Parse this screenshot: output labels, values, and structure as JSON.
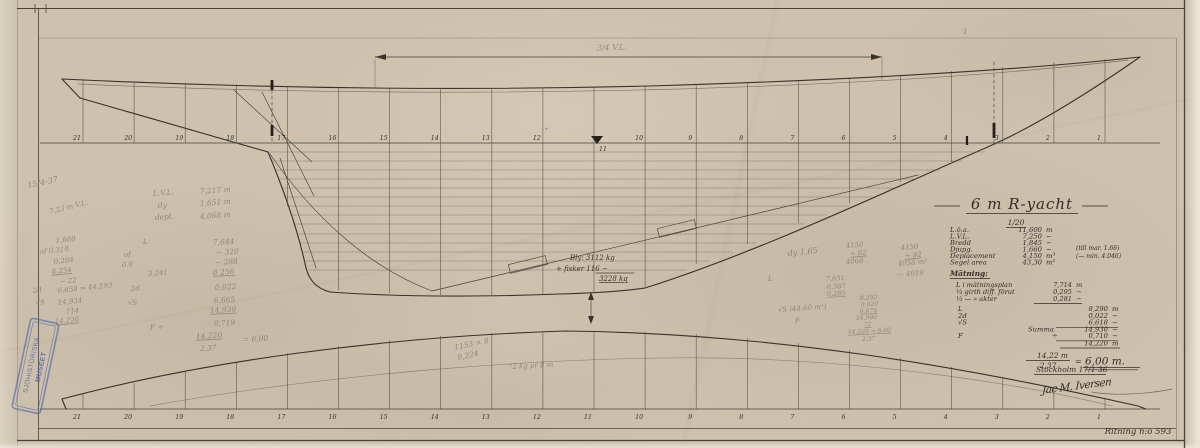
{
  "dimension_label": "3/4 V.L.",
  "top_mark": "1",
  "stations": [
    "21",
    "20",
    "19",
    "18",
    "17",
    "16",
    "15",
    "14",
    "13",
    "12",
    "11",
    "10",
    "9",
    "8",
    "7",
    "6",
    "5",
    "4",
    "3",
    "2",
    "1"
  ],
  "ink_notes": [
    {
      "t": "Bly: 3112 kg",
      "x": 570,
      "y": 260,
      "s": 7
    },
    {
      "t": "+ fisker 116 −",
      "x": 556,
      "y": 271,
      "s": 7
    },
    {
      "t": "3228 kg",
      "x": 599,
      "y": 281,
      "s": 7,
      "u": 1
    }
  ],
  "pencil_notes": [
    {
      "t": "15/4-37",
      "x": 28,
      "y": 188,
      "s": 8,
      "r": -12
    },
    {
      "t": "7,23 m  V.L.",
      "x": 50,
      "y": 214,
      "s": 7,
      "r": -14
    },
    {
      "t": "L.V.L.",
      "x": 153,
      "y": 196,
      "s": 7.5,
      "r": -4
    },
    {
      "t": "7,217 m",
      "x": 200,
      "y": 194,
      "s": 7.5,
      "r": -4
    },
    {
      "t": "dy",
      "x": 158,
      "y": 208,
      "s": 7.5,
      "r": -4
    },
    {
      "t": "1,651 m",
      "x": 200,
      "y": 206,
      "s": 7.5,
      "r": -4
    },
    {
      "t": "depl.",
      "x": 155,
      "y": 220,
      "s": 7.5,
      "r": -4
    },
    {
      "t": "4,068 m",
      "x": 200,
      "y": 219,
      "s": 7.5,
      "r": -4
    },
    {
      "t": "1,660",
      "x": 56,
      "y": 243,
      "s": 7,
      "r": -6
    },
    {
      "t": "of 0,310",
      "x": 40,
      "y": 254,
      "s": 7,
      "r": -6
    },
    {
      "t": "0,284",
      "x": 54,
      "y": 264,
      "s": 7,
      "r": -6
    },
    {
      "t": "8,254",
      "x": 52,
      "y": 274,
      "s": 7,
      "r": -6,
      "u": 1
    },
    {
      "t": "− 22",
      "x": 60,
      "y": 284,
      "s": 7,
      "r": -6
    },
    {
      "t": "2d",
      "x": 33,
      "y": 293,
      "s": 7,
      "r": -6
    },
    {
      "t": "6,658 = 44,193",
      "x": 58,
      "y": 293,
      "s": 7,
      "r": -6
    },
    {
      "t": "√S",
      "x": 36,
      "y": 305,
      "s": 7,
      "r": -6
    },
    {
      "t": "14,934",
      "x": 58,
      "y": 305,
      "s": 7,
      "r": -6
    },
    {
      "t": "714",
      "x": 66,
      "y": 314,
      "s": 7,
      "r": -6
    },
    {
      "t": "14,220",
      "x": 55,
      "y": 324,
      "s": 7,
      "r": -6,
      "u": 1
    },
    {
      "t": "L",
      "x": 143,
      "y": 244,
      "s": 7,
      "r": -4
    },
    {
      "t": "of.",
      "x": 124,
      "y": 257,
      "s": 7,
      "r": -4
    },
    {
      "t": "0.0",
      "x": 122,
      "y": 267,
      "s": 7,
      "r": -4
    },
    {
      "t": "3,241",
      "x": 148,
      "y": 276,
      "s": 7,
      "r": -4
    },
    {
      "t": "2d",
      "x": 131,
      "y": 291,
      "s": 7,
      "r": -4
    },
    {
      "t": "√S",
      "x": 128,
      "y": 305,
      "s": 7,
      "r": -4
    },
    {
      "t": "F   ÷",
      "x": 150,
      "y": 330,
      "s": 7.5,
      "r": -4
    },
    {
      "t": "7,644",
      "x": 213,
      "y": 245,
      "s": 7.5,
      "r": -3
    },
    {
      "t": "− 320",
      "x": 216,
      "y": 255,
      "s": 7.5,
      "r": -3
    },
    {
      "t": "− 288",
      "x": 215,
      "y": 265,
      "s": 7.5,
      "r": -3
    },
    {
      "t": "8 256",
      "x": 213,
      "y": 275,
      "s": 7.5,
      "r": -3,
      "u": 1
    },
    {
      "t": "0,022",
      "x": 215,
      "y": 290,
      "s": 7.5,
      "r": -3
    },
    {
      "t": "6,665",
      "x": 214,
      "y": 303,
      "s": 7.5,
      "r": -3
    },
    {
      "t": "14,939",
      "x": 210,
      "y": 313,
      "s": 7.5,
      "r": -3,
      "u": 1
    },
    {
      "t": "0,719",
      "x": 214,
      "y": 326,
      "s": 7.5,
      "r": -3
    },
    {
      "t": "14,220",
      "x": 196,
      "y": 339,
      "s": 7.5,
      "r": -3,
      "u": 1
    },
    {
      "t": "= 6,00",
      "x": 243,
      "y": 342,
      "s": 7.5,
      "r": -3
    },
    {
      "t": "2,37",
      "x": 200,
      "y": 351,
      "s": 7.5,
      "r": -3
    },
    {
      "t": "dy 1,65",
      "x": 788,
      "y": 256,
      "s": 8,
      "r": -6
    },
    {
      "t": "L",
      "x": 768,
      "y": 281,
      "s": 7,
      "r": -3
    },
    {
      "t": "7,631",
      "x": 826,
      "y": 281,
      "s": 6.5,
      "r": -3
    },
    {
      "t": "0,387",
      "x": 827,
      "y": 289,
      "s": 6.5,
      "r": -3
    },
    {
      "t": "0,285",
      "x": 827,
      "y": 296,
      "s": 6.5,
      "r": -3,
      "u": 1
    },
    {
      "t": "√S (44,60 m³)",
      "x": 778,
      "y": 312,
      "s": 7,
      "r": -4
    },
    {
      "t": "F",
      "x": 795,
      "y": 323,
      "s": 7,
      "r": -4
    },
    {
      "t": "4150",
      "x": 846,
      "y": 248,
      "s": 7,
      "r": -5
    },
    {
      "t": "÷ 82",
      "x": 850,
      "y": 256,
      "s": 7,
      "r": -5,
      "u": 1
    },
    {
      "t": "4068",
      "x": 846,
      "y": 264,
      "s": 7,
      "r": -5
    },
    {
      "t": "4150",
      "x": 901,
      "y": 250,
      "s": 7,
      "r": -5
    },
    {
      "t": "÷ 92",
      "x": 905,
      "y": 258,
      "s": 7,
      "r": -5,
      "u": 1
    },
    {
      "t": "4058 m³",
      "x": 898,
      "y": 266,
      "s": 7,
      "r": -5
    },
    {
      "t": "— 4019",
      "x": 897,
      "y": 277,
      "s": 7,
      "r": -5
    },
    {
      "t": "8,292",
      "x": 860,
      "y": 300,
      "s": 6,
      "r": -3
    },
    {
      "t": "0,020",
      "x": 861,
      "y": 306.5,
      "s": 6,
      "r": -3
    },
    {
      "t": "6,678",
      "x": 860,
      "y": 313,
      "s": 6,
      "r": -3,
      "u": 1
    },
    {
      "t": "14,990",
      "x": 856,
      "y": 320,
      "s": 6,
      "r": -3
    },
    {
      "t": "72",
      "x": 864,
      "y": 326.5,
      "s": 6,
      "r": -3,
      "u": 1
    },
    {
      "t": "14,220 = 6,00",
      "x": 848,
      "y": 334,
      "s": 6,
      "r": -3,
      "u": 1
    },
    {
      "t": "2,37",
      "x": 862,
      "y": 341,
      "s": 6,
      "r": -3
    },
    {
      "t": "1153 × 8",
      "x": 455,
      "y": 350,
      "s": 7.5,
      "r": -12
    },
    {
      "t": "9,224",
      "x": 458,
      "y": 360,
      "s": 7.5,
      "r": -12
    },
    {
      "t": "72 kg pr 8 m",
      "x": 508,
      "y": 369,
      "s": 7,
      "r": -3
    },
    {
      "t": "+",
      "x": 544,
      "y": 131,
      "s": 6,
      "r": 0
    }
  ],
  "title_block": {
    "title": "6 m R-yacht",
    "scale": "1/20",
    "specs": [
      {
        "label": "L.ö.a.",
        "value": "11,600",
        "unit": "m"
      },
      {
        "label": "L.V.L.",
        "value": "7,250",
        "unit": "−"
      },
      {
        "label": "Bredd",
        "value": "1,845",
        "unit": "−"
      },
      {
        "label": "Djupg.",
        "value": "1,660",
        "unit": "−"
      },
      {
        "label": "Deplacement",
        "value": "4,150",
        "unit": "m³"
      },
      {
        "label": "Segel area",
        "value": "43,30",
        "unit": "m²"
      }
    ],
    "spec_notes": [
      "(till mar. 1.66)",
      "(— min. 4.046)"
    ],
    "matning_heading": "Mätning:",
    "matning_rows": [
      {
        "label": "L  i mätningsplan",
        "value": "7,714",
        "unit": "m"
      },
      {
        "label": "⅓ girth diff. förut",
        "value": "0,295",
        "unit": "−"
      },
      {
        "label": "⅓ — » akter",
        "value": "0,281",
        "unit": "−"
      }
    ],
    "sum_rows": [
      {
        "label": "L",
        "value": "8,290",
        "unit": "m"
      },
      {
        "label": "2d",
        "value": "0,022",
        "unit": "−"
      },
      {
        "label": "√S",
        "value": "6,618",
        "unit": "−"
      },
      {
        "label": "Summa",
        "value": "14,930",
        "unit": "−"
      },
      {
        "label": "F",
        "op": "÷",
        "value": "0,710",
        "unit": "−"
      },
      {
        "label": "",
        "value": "14,220",
        "unit": "m"
      }
    ],
    "formula": {
      "num": "14,22 m",
      "den": "2,37",
      "eq": "=",
      "res": "6,00 m."
    },
    "place_date": "Stockholm 17/1-36",
    "signature": "Jac M. Iversen"
  },
  "footer": {
    "drawing_no": "Ritning n:o 593"
  },
  "stamp": {
    "line1": "SJÖHISTORISKA",
    "line2": "MUSEET"
  }
}
